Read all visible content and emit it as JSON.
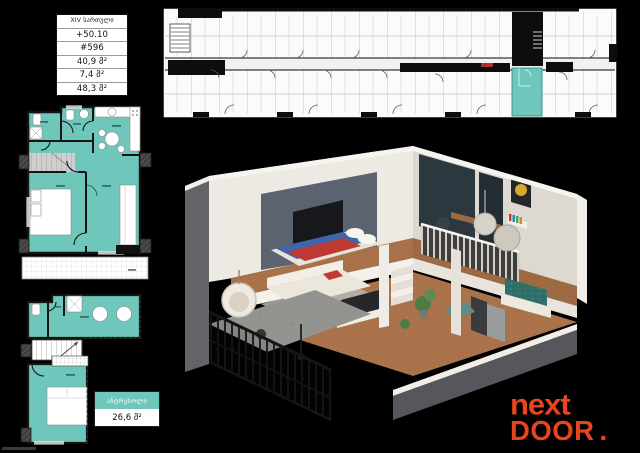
{
  "meta": {
    "background": "#000000"
  },
  "info_table": {
    "floor": "XIV სართული",
    "elevation": "+50.10",
    "unit": "#596",
    "area_living": "40,9 მ²",
    "area_balcony": "7,4 მ²",
    "area_total": "48,3 მ²"
  },
  "mezzanine_label": {
    "title": "ანტრესოლი",
    "area": "26,6 მ²"
  },
  "logo": {
    "word_top": "next",
    "word_bottom": "DOOR",
    "dot": "."
  },
  "plan_colors": {
    "highlight_teal": "#6FC6BA",
    "wall_black": "#141414",
    "logo_red": "#E8441D",
    "stair_gray": "#CFCFCF"
  }
}
